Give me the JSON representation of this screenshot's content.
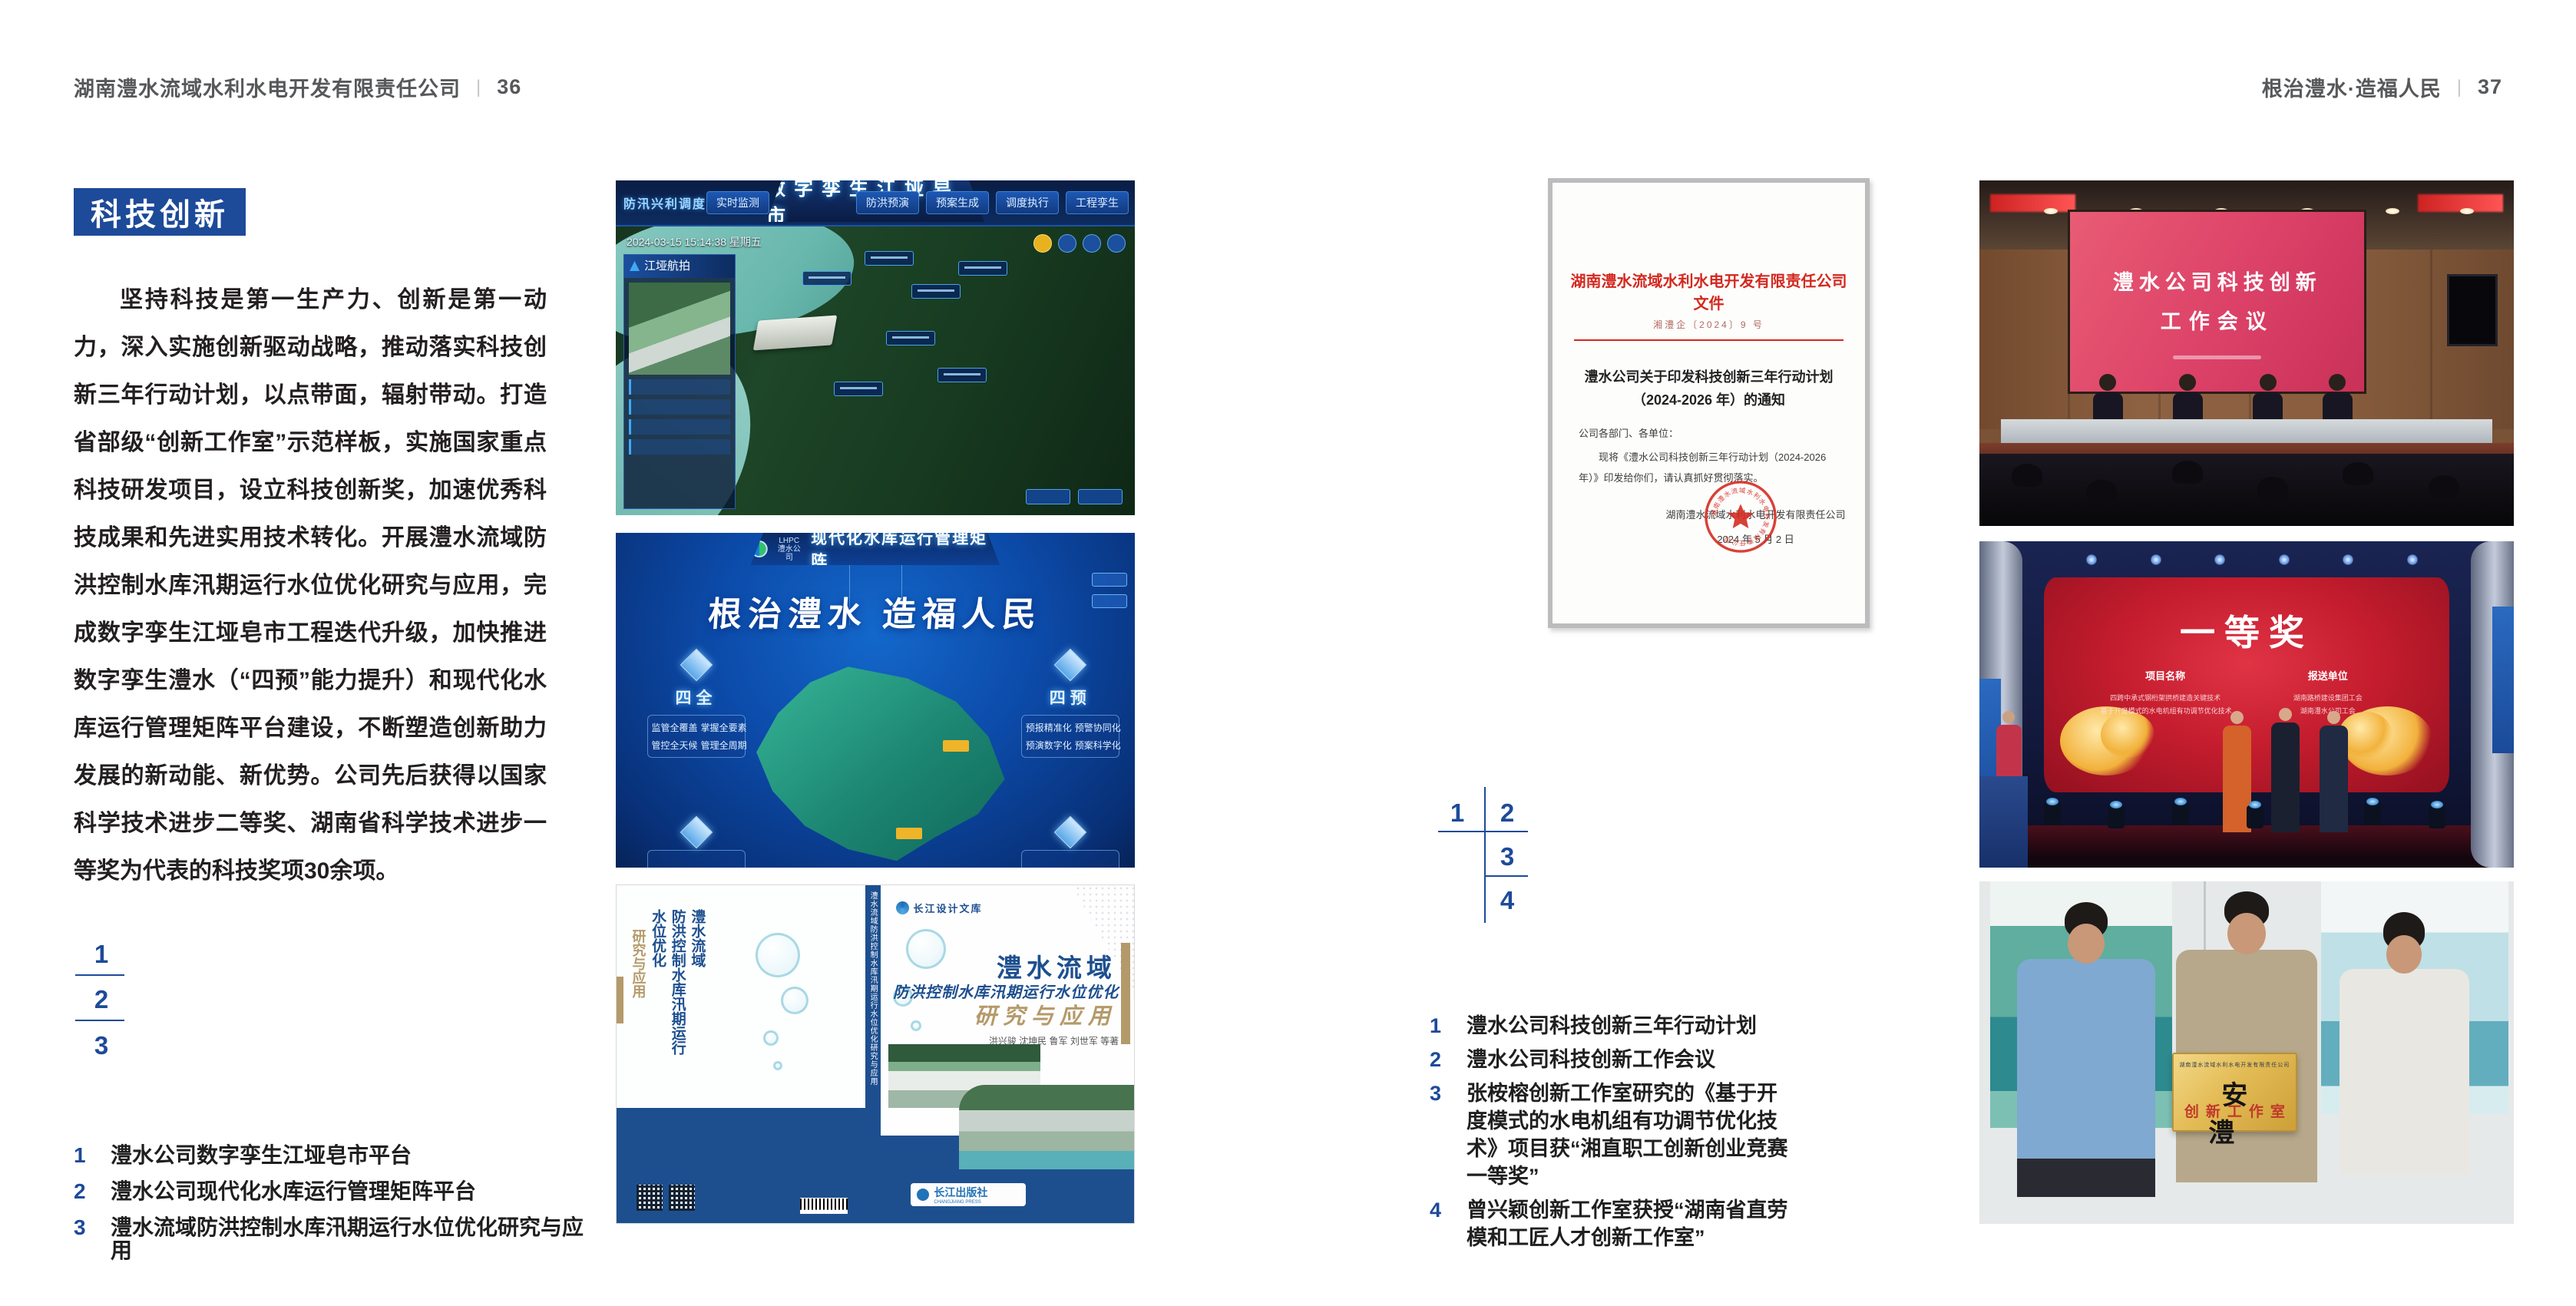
{
  "left_page": {
    "header": {
      "company": "湖南澧水流域水利水电开发有限责任公司",
      "separator": "|",
      "page_number": "36"
    },
    "badge": "科技创新",
    "body_text": "坚持科技是第一生产力、创新是第一动力，深入实施创新驱动战略，推动落实科技创新三年行动计划，以点带面，辐射带动。打造省部级“创新工作室”示范样板，实施国家重点科技研发项目，设立科技创新奖，加速优秀科技成果和先进实用技术转化。开展澧水流域防洪控制水库汛期运行水位优化研究与应用，完成数字孪生江垭皂市工程迭代升级，加快推进数字孪生澧水（“四预”能力提升）和现代化水库运行管理矩阵平台建设，不断塑造创新助力发展的新动能、新优势。公司先后获得以国家科学技术进步二等奖、湖南省科学技术进步一等奖为代表的科技奖项30余项。",
    "figure_index": [
      "1",
      "2",
      "3"
    ],
    "captions": [
      {
        "num": "1",
        "text": "澧水公司数字孪生江垭皂市平台"
      },
      {
        "num": "2",
        "text": "澧水公司现代化水库运行管理矩阵平台"
      },
      {
        "num": "3",
        "text": "澧水流域防洪控制水库汛期运行水位优化研究与应用"
      }
    ],
    "dashboard": {
      "title": "数字孪生江垭皂市",
      "corner_label": "防汛兴利调度",
      "nav_left": [
        "实时监测",
        "洪水预报",
        "防汛预警"
      ],
      "nav_right": [
        "防洪预演",
        "预案生成",
        "调度执行",
        "工程孪生"
      ],
      "timestamp": "2024-03-15 15:14:38 星期五",
      "panel_title": "江垭航拍"
    },
    "matrix": {
      "logo_abbr": "LHPC",
      "logo_text": "澧水公司",
      "title": "现代化水库运行管理矩阵",
      "slogan": "根治澧水 造福人民",
      "node_left": {
        "label": "四全",
        "items": [
          "监管全覆盖",
          "掌握全要素",
          "管控全天候",
          "管理全周期"
        ]
      },
      "node_right": {
        "label": "四预",
        "items": [
          "预报精准化",
          "预警协同化",
          "预演数字化",
          "预案科学化"
        ]
      }
    },
    "book": {
      "series": "长江设计文库",
      "back_title_1": "澧水流域",
      "back_title_2": "防洪控制水库汛期运行水位优化",
      "back_title_3": "研究与应用",
      "spine_text": "澧水流域防洪控制水库汛期运行水位优化研究与应用",
      "title_line1": "澧水流域",
      "title_line2": "防洪控制水库汛期运行水位优化",
      "title_line3": "研究与应用",
      "authors": "洪兴骏 沈坤民 鲁军 刘世军 等著",
      "publisher": "长江出版社",
      "publisher_en": "CHANGJIANG PRESS"
    }
  },
  "right_page": {
    "header": {
      "slogan": "根治澧水·造福人民",
      "separator": "|",
      "page_number": "37"
    },
    "document": {
      "red_title": "湖南澧水流域水利水电开发有限责任公司文件",
      "doc_number": "湘澧企〔2024〕9 号",
      "title_line1": "澧水公司关于印发科技创新三年行动计划",
      "title_line2": "（2024-2026 年）的通知",
      "salutation": "公司各部门、各单位：",
      "body": "现将《澧水公司科技创新三年行动计划（2024-2026 年）》印发给你们，请认真抓好贯彻落实。",
      "signature": "湖南澧水流域水利水电开发有限责任公司",
      "date": "2024 年 5 月 2 日",
      "seal_text": "湖南澧水流域水利水电开发有限责任公司"
    },
    "figure_index": [
      "1",
      "2",
      "3",
      "4"
    ],
    "captions": [
      {
        "num": "1",
        "text": "澧水公司科技创新三年行动计划"
      },
      {
        "num": "2",
        "text": "澧水公司科技创新工作会议"
      },
      {
        "num": "3",
        "text": "张桉榕创新工作室研究的《基于开度模式的水电机组有功调节优化技术》项目获“湘直职工创新创业竞赛一等奖”"
      },
      {
        "num": "4",
        "text": "曾兴颖创新工作室获授“湖南省直劳模和工匠人才创新工作室”"
      }
    ],
    "meeting_photo": {
      "banner_line1": "澧水公司科技创新",
      "banner_line2": "工作会议"
    },
    "award_photo": {
      "headline": "一等奖",
      "col1_title": "项目名称",
      "col1_items": [
        "四跨中承式钢桁架拱桥建造关键技术",
        "基于开度模式的水电机组有功调节优化技术"
      ],
      "col2_title": "报送单位",
      "col2_items": [
        "湖南路桥建设集团工会",
        "湖南澧水公司工会"
      ]
    },
    "group_photo": {
      "plaque_org": "湖南澧水流域水利水电开发有限责任公司",
      "plaque_main": "安澧",
      "plaque_sub": "创新工作室"
    }
  }
}
